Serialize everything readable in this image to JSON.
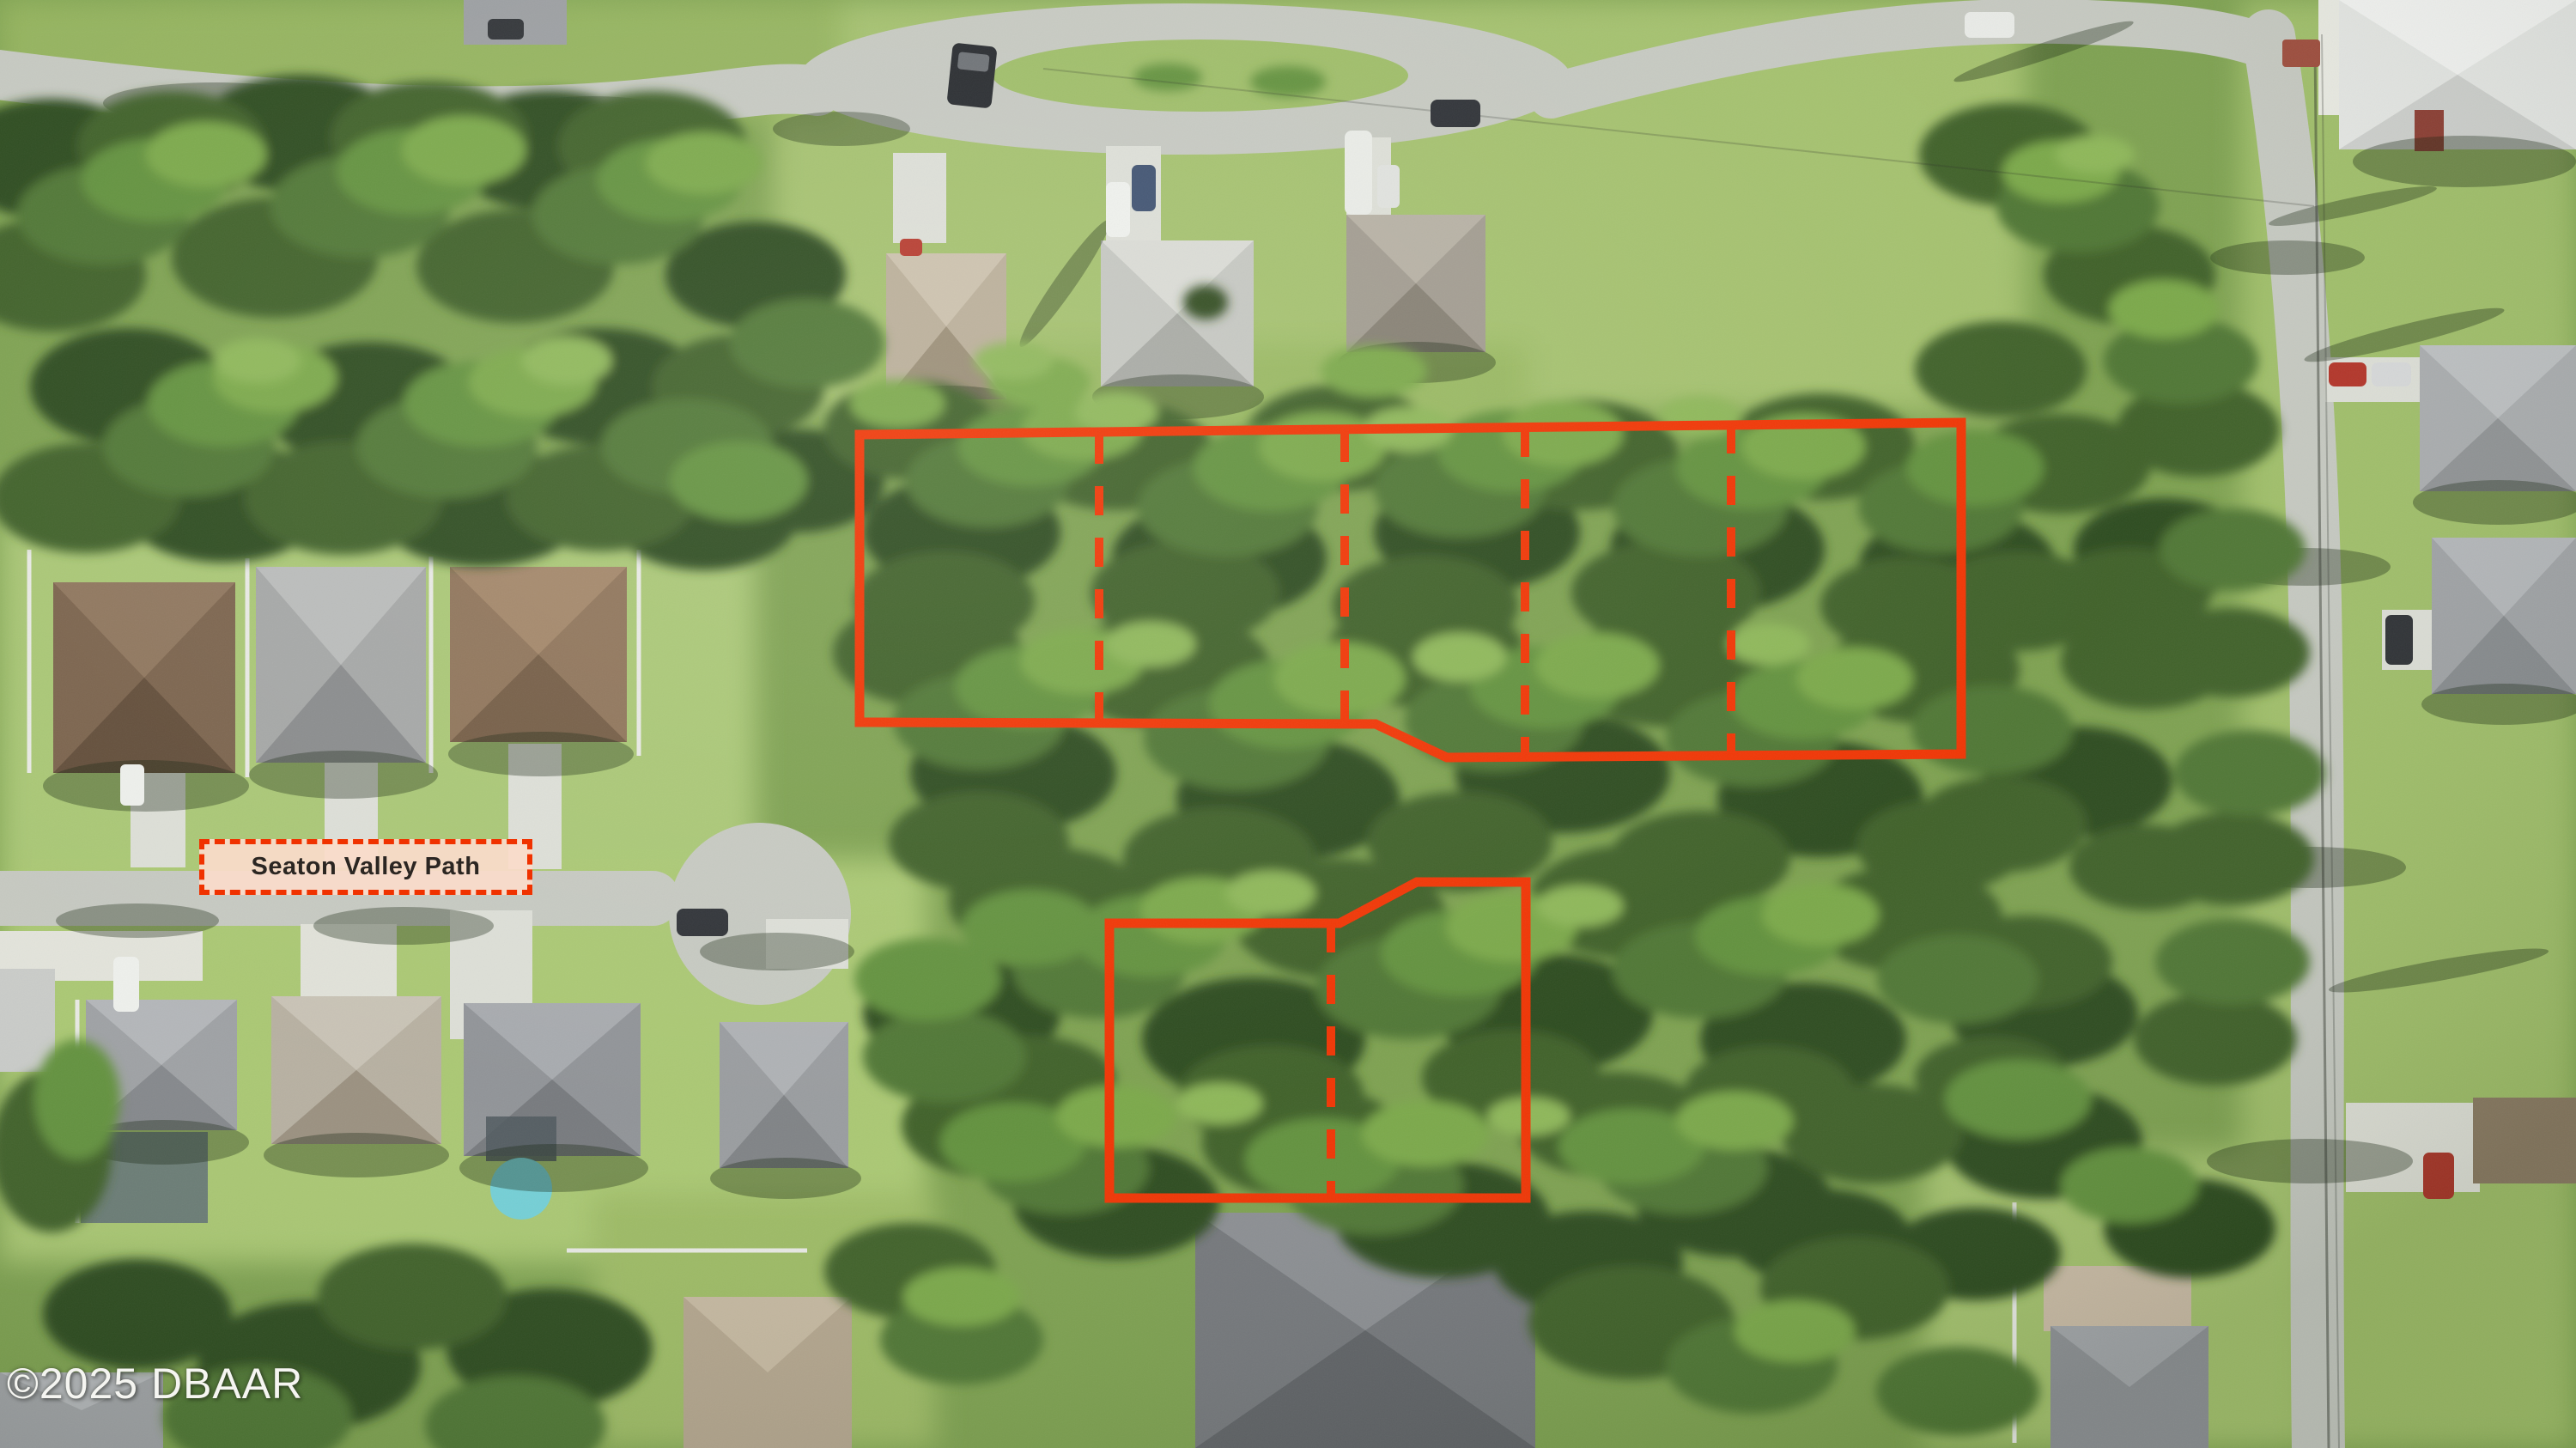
{
  "overlay": {
    "street_label": {
      "text": "Seaton Valley Path"
    },
    "watermark": {
      "text": "©2025 DBAAR"
    },
    "colors": {
      "annotation_red": "#f03200",
      "label_fill": "#fadcca",
      "label_text": "#2b2622",
      "watermark_text": "#f5f5f1"
    },
    "parcels": [
      {
        "id": "north-parcel",
        "outline": "1001,506 2284,492 2284,878 1685,882 1602,843 1001,841",
        "dividers": [
          "1280,506 1280,841",
          "1566,504 1566,842",
          "1776,498 1776,880",
          "2016,494 2016,879"
        ]
      },
      {
        "id": "south-parcel",
        "outline": "1292,1075 1560,1075 1650,1027 1777,1027 1777,1395 1292,1395",
        "dividers": [
          "1550,1075 1550,1395"
        ]
      }
    ]
  }
}
